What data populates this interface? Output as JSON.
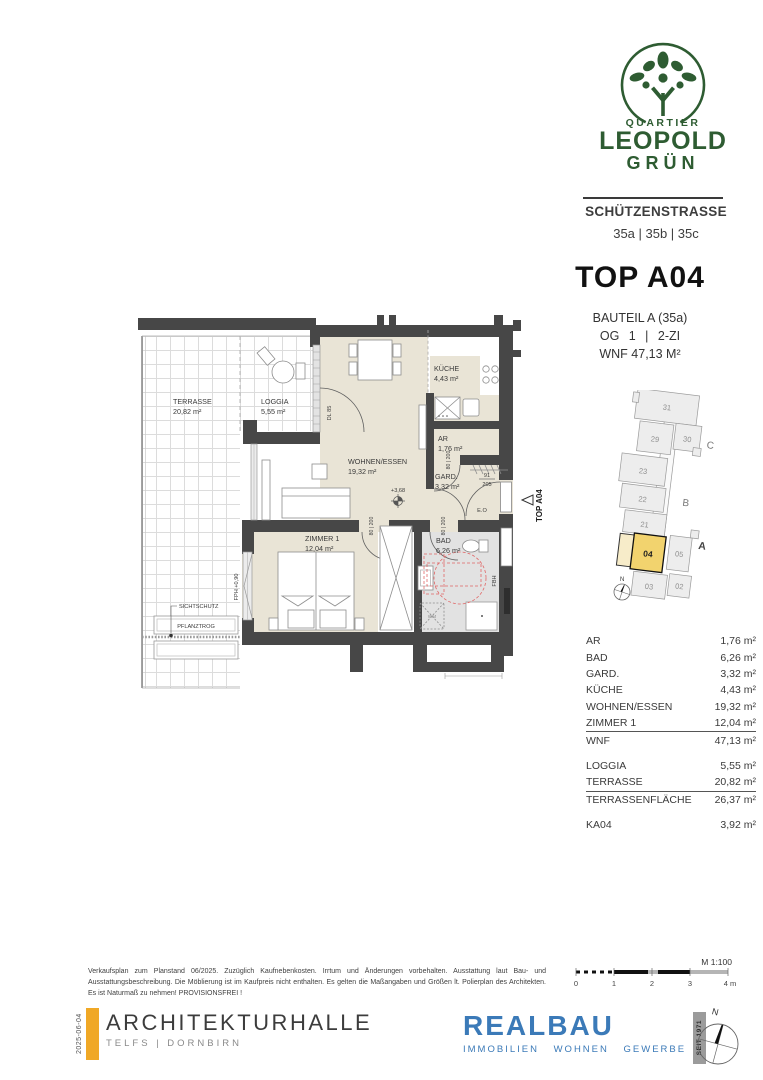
{
  "brand": {
    "quartier": "QUARTIER",
    "leopold": "LEOPOLD",
    "gruen": "GRÜN",
    "street": "SCHÜTZENSTRASSE",
    "numbers": "35a | 35b | 35c"
  },
  "unit": {
    "title": "TOP A04",
    "bauteil": "BAUTEIL A (35a)",
    "floor_line": "OG 1 | 2-ZI",
    "wnf": "WNF 47,13 M²"
  },
  "site": {
    "n31": "31",
    "n30": "30",
    "n29": "29",
    "n23": "23",
    "n22": "22",
    "n21": "21",
    "n04": "04",
    "n05": "05",
    "n03": "03",
    "n02": "02",
    "c": "C",
    "b": "B",
    "a": "A",
    "north": "N"
  },
  "plan": {
    "terrasse": {
      "name": "TERRASSE",
      "area": "20,82 m²"
    },
    "loggia": {
      "name": "LOGGIA",
      "area": "5,55 m²"
    },
    "wohnen": {
      "name": "WOHNEN/ESSEN",
      "area": "19,32 m²"
    },
    "kueche": {
      "name": "KÜCHE",
      "area": "4,43 m²"
    },
    "ar": {
      "name": "AR",
      "area": "1,76 m²"
    },
    "gard": {
      "name": "GARD.",
      "area": "3,32 m²"
    },
    "bad": {
      "name": "BAD",
      "area": "6,26 m²"
    },
    "zimmer": {
      "name": "ZIMMER 1",
      "area": "12,04 m²"
    },
    "ann": {
      "level": "+3,68",
      "dl": "DL 85",
      "fph": "FPH +0,90",
      "sicht": "SICHTSCHUTZ",
      "pflanz": "PFLANZTROG",
      "eo": "E.O",
      "fbh": "FBH",
      "wm": "WM",
      "door": "80 | 200",
      "entry_top": "91",
      "entry_bottom": "205",
      "arrow": "TOP A04"
    }
  },
  "table": {
    "rows": [
      {
        "label": "AR",
        "value": "1,76 m²"
      },
      {
        "label": "BAD",
        "value": "6,26 m²"
      },
      {
        "label": "GARD.",
        "value": "3,32 m²"
      },
      {
        "label": "KÜCHE",
        "value": "4,43 m²"
      },
      {
        "label": "WOHNEN/ESSEN",
        "value": "19,32 m²"
      },
      {
        "label": "ZIMMER 1",
        "value": "12,04 m²"
      },
      {
        "label": "WNF",
        "value": "47,13 m²"
      },
      {
        "label": "LOGGIA",
        "value": "5,55 m²"
      },
      {
        "label": "TERRASSE",
        "value": "20,82 m²"
      },
      {
        "label": "TERRASSENFLÄCHE",
        "value": "26,37 m²"
      },
      {
        "label": "KA04",
        "value": "3,92 m²"
      }
    ]
  },
  "footer": {
    "disclaimer": "Verkaufsplan zum Planstand 06/2025. Zuzüglich Kaufnebenkosten. Irrtum und Änderungen vorbehalten. Ausstattung laut Bau- und Ausstattungsbeschreibung. Die Möblierung ist im Kaufpreis nicht enthalten. Es gelten die Maßangaben und Größen lt. Polierplan des Architekten. Es ist Naturmaß zu nehmen!  PROVISIONSFREI !",
    "arch": {
      "date": "2025-06-04",
      "name": "ARCHITEKTURHALLE",
      "sub": "TELFS | DORNBIRN"
    },
    "realbau": {
      "name": "REALBAU",
      "sub": "IMMOBILIEN WOHNEN GEWERBE",
      "seit": "SEIT 1971"
    },
    "scale": {
      "label": "M 1:100",
      "t0": "0",
      "t1": "1",
      "t2": "2",
      "t3": "3",
      "t4": "4 m"
    },
    "compass_n": "N"
  }
}
